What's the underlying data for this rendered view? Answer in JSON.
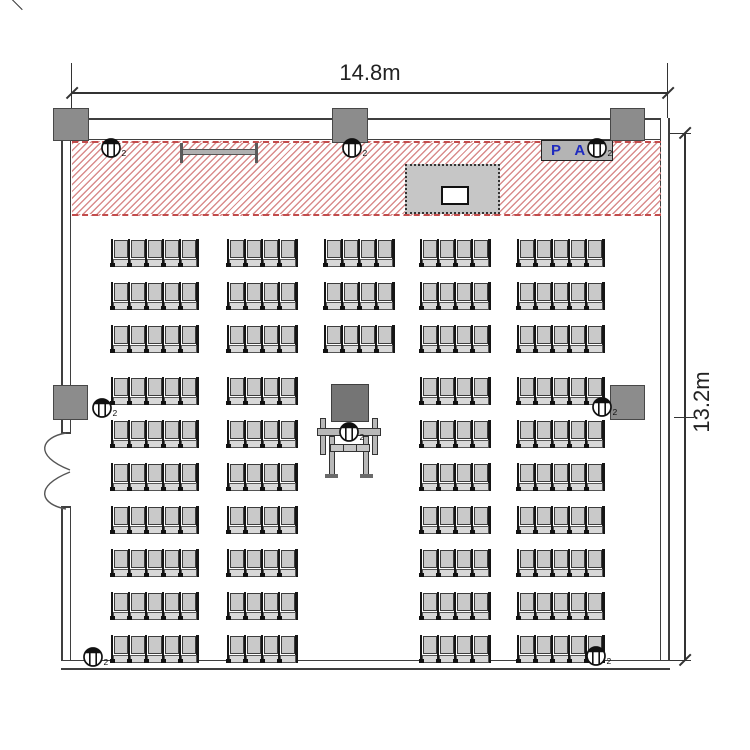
{
  "dims": {
    "width": "14.8m",
    "height": "13.2m"
  },
  "stage": {
    "pa_label": "P A"
  },
  "speaker_sub": "2",
  "colors": {
    "hatch_line": "#d98c8c",
    "hatch_border": "#c24b4b",
    "wall_line": "#3f3f3f",
    "pillar_fill": "#8c8c8c",
    "seat_fill": "#c9c9c9",
    "pa_text": "#1f2bbf",
    "projector_fill": "#757575",
    "background": "#ffffff"
  },
  "seating": {
    "row_y": [
      239,
      282,
      325,
      377,
      420,
      463,
      506,
      549,
      592,
      635
    ],
    "columns": [
      {
        "x": 111,
        "seats": 5
      },
      {
        "x": 227,
        "seats": 4
      },
      {
        "x": 324,
        "seats": 4
      },
      {
        "x": 420,
        "seats": 4
      },
      {
        "x": 517,
        "seats": 5
      }
    ],
    "center_column_index": 2,
    "center_column_row_count": 3,
    "total_seats": 192
  },
  "speakers": [
    {
      "x": 111,
      "y": 148
    },
    {
      "x": 352,
      "y": 148
    },
    {
      "x": 597,
      "y": 148
    },
    {
      "x": 102,
      "y": 408
    },
    {
      "x": 602,
      "y": 407
    },
    {
      "x": 349,
      "y": 432
    },
    {
      "x": 93,
      "y": 657
    },
    {
      "x": 596,
      "y": 656
    }
  ],
  "pillars": [
    {
      "x": 53,
      "y": 108,
      "w": 36,
      "h": 33
    },
    {
      "x": 332,
      "y": 108,
      "w": 36,
      "h": 35
    },
    {
      "x": 610,
      "y": 108,
      "w": 35,
      "h": 33
    }
  ],
  "wall_boxes": [
    {
      "x": 53,
      "y": 385,
      "w": 35,
      "h": 35
    },
    {
      "x": 610,
      "y": 385,
      "w": 35,
      "h": 35
    }
  ]
}
